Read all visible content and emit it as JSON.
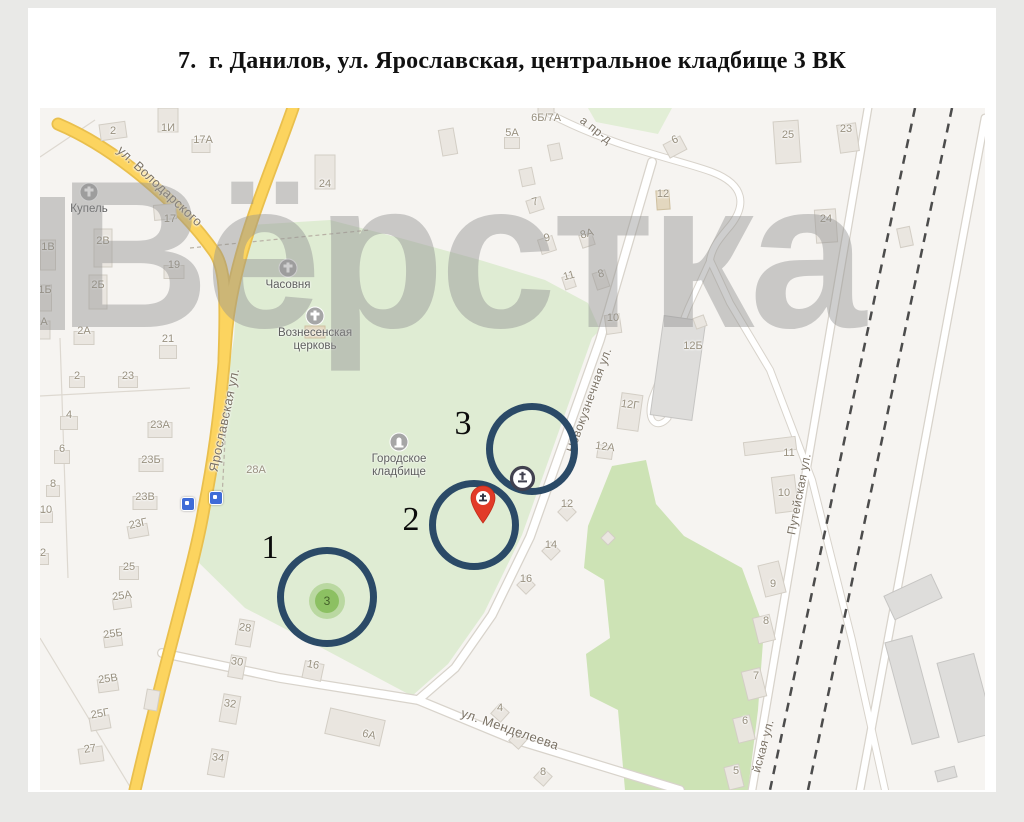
{
  "page": {
    "title": "7.  г. Данилов, ул. Ярославская, центральное кладбище 3 ВК"
  },
  "watermark": {
    "text": "Вёрстка"
  },
  "map": {
    "colors": {
      "circle_stroke": "#2b4a67",
      "pin_red": "#e23b28",
      "badge_ring": "#41414f",
      "green_point_fill": "#8cc062",
      "road_yellow": "#fcd45f",
      "cemetery_green": "#dfecd3"
    },
    "street_labels": [
      {
        "t": "ул. Володарского",
        "x": 120,
        "y": 78,
        "r": 43,
        "s": 13
      },
      {
        "t": "Ярославская ул.",
        "x": 184,
        "y": 312,
        "r": -78,
        "s": 13
      },
      {
        "t": "Новокузнечная ул.",
        "x": 549,
        "y": 292,
        "r": -70,
        "s": 12
      },
      {
        "t": "Путейская ул.",
        "x": 759,
        "y": 386,
        "r": -79,
        "s": 12
      },
      {
        "t": "йская ул.",
        "x": 723,
        "y": 638,
        "r": -75,
        "s": 12
      },
      {
        "t": "ул. Менделеева",
        "x": 470,
        "y": 621,
        "r": 19,
        "s": 13
      },
      {
        "t": "а пр-д",
        "x": 556,
        "y": 22,
        "r": 38,
        "s": 12
      }
    ],
    "building_labels": [
      {
        "t": "2",
        "x": 73,
        "y": 23
      },
      {
        "t": "1И",
        "x": 128,
        "y": 20
      },
      {
        "t": "17А",
        "x": 163,
        "y": 32
      },
      {
        "t": "24",
        "x": 285,
        "y": 76
      },
      {
        "t": "17",
        "x": 130,
        "y": 111
      },
      {
        "t": "2В",
        "x": 63,
        "y": 133
      },
      {
        "t": "1В",
        "x": 8,
        "y": 139
      },
      {
        "t": "19",
        "x": 134,
        "y": 157
      },
      {
        "t": "2Б",
        "x": 58,
        "y": 177
      },
      {
        "t": "1Б",
        "x": 5,
        "y": 182
      },
      {
        "t": "А",
        "x": 4,
        "y": 214
      },
      {
        "t": "2А",
        "x": 44,
        "y": 223
      },
      {
        "t": "21",
        "x": 128,
        "y": 231
      },
      {
        "t": "2",
        "x": 37,
        "y": 268
      },
      {
        "t": "23",
        "x": 88,
        "y": 268
      },
      {
        "t": "4",
        "x": 29,
        "y": 307
      },
      {
        "t": "23А",
        "x": 120,
        "y": 317
      },
      {
        "t": "6",
        "x": 22,
        "y": 341
      },
      {
        "t": "23Б",
        "x": 111,
        "y": 352
      },
      {
        "t": "8",
        "x": 13,
        "y": 376
      },
      {
        "t": "23В",
        "x": 105,
        "y": 389
      },
      {
        "t": "10",
        "x": 6,
        "y": 402
      },
      {
        "t": "23Г",
        "x": 98,
        "y": 416,
        "r": -12
      },
      {
        "t": "25",
        "x": 89,
        "y": 459
      },
      {
        "t": "2",
        "x": 3,
        "y": 445
      },
      {
        "t": "25А",
        "x": 82,
        "y": 488,
        "r": -8
      },
      {
        "t": "25Б",
        "x": 73,
        "y": 526,
        "r": -8
      },
      {
        "t": "25В",
        "x": 68,
        "y": 571,
        "r": -8
      },
      {
        "t": "25Г",
        "x": 60,
        "y": 606,
        "r": -10
      },
      {
        "t": "27",
        "x": 50,
        "y": 641,
        "r": -8
      },
      {
        "t": "28",
        "x": 205,
        "y": 520,
        "r": 8
      },
      {
        "t": "30",
        "x": 197,
        "y": 554,
        "r": 8
      },
      {
        "t": "32",
        "x": 190,
        "y": 596,
        "r": 8
      },
      {
        "t": "34",
        "x": 178,
        "y": 650,
        "r": 8
      },
      {
        "t": "16",
        "x": 273,
        "y": 557,
        "r": 10
      },
      {
        "t": "6А",
        "x": 329,
        "y": 627,
        "r": 13
      },
      {
        "t": "28А",
        "x": 216,
        "y": 362
      },
      {
        "t": "4",
        "x": 460,
        "y": 600
      },
      {
        "t": "6",
        "x": 478,
        "y": 627
      },
      {
        "t": "8",
        "x": 503,
        "y": 664
      },
      {
        "t": "5А",
        "x": 472,
        "y": 25
      },
      {
        "t": "6Б/7А",
        "x": 506,
        "y": 10
      },
      {
        "t": "7",
        "x": 495,
        "y": 94,
        "r": -15
      },
      {
        "t": "9",
        "x": 507,
        "y": 130,
        "r": -15
      },
      {
        "t": "8А",
        "x": 547,
        "y": 126,
        "r": -15
      },
      {
        "t": "6",
        "x": 635,
        "y": 32,
        "r": -25
      },
      {
        "t": "25",
        "x": 748,
        "y": 27
      },
      {
        "t": "23",
        "x": 806,
        "y": 21
      },
      {
        "t": "12",
        "x": 623,
        "y": 86
      },
      {
        "t": "24",
        "x": 786,
        "y": 111
      },
      {
        "t": "8",
        "x": 561,
        "y": 166,
        "r": -15
      },
      {
        "t": "11",
        "x": 529,
        "y": 168,
        "r": -15
      },
      {
        "t": "10",
        "x": 573,
        "y": 210
      },
      {
        "t": "12Б",
        "x": 653,
        "y": 238
      },
      {
        "t": "12Г",
        "x": 590,
        "y": 297,
        "r": 8
      },
      {
        "t": "12А",
        "x": 565,
        "y": 339,
        "r": 8
      },
      {
        "t": "12",
        "x": 527,
        "y": 396
      },
      {
        "t": "14",
        "x": 511,
        "y": 437
      },
      {
        "t": "16",
        "x": 486,
        "y": 471
      },
      {
        "t": "11",
        "x": 749,
        "y": 345
      },
      {
        "t": "10",
        "x": 744,
        "y": 385
      },
      {
        "t": "9",
        "x": 733,
        "y": 476
      },
      {
        "t": "8",
        "x": 726,
        "y": 513
      },
      {
        "t": "7",
        "x": 716,
        "y": 568
      },
      {
        "t": "6",
        "x": 705,
        "y": 613
      },
      {
        "t": "5",
        "x": 696,
        "y": 663
      }
    ],
    "building_footprints": [
      [
        73,
        23,
        26,
        16,
        -8,
        0
      ],
      [
        128,
        12,
        20,
        24,
        0,
        0
      ],
      [
        161,
        38,
        18,
        13,
        0,
        0
      ],
      [
        285,
        64,
        20,
        34,
        0,
        0
      ],
      [
        125,
        104,
        22,
        15,
        -5,
        0
      ],
      [
        63,
        140,
        18,
        38,
        0,
        0
      ],
      [
        8,
        147,
        15,
        30,
        0,
        0
      ],
      [
        134,
        164,
        20,
        13,
        0,
        0
      ],
      [
        58,
        184,
        18,
        34,
        0,
        0
      ],
      [
        5,
        190,
        13,
        26,
        0,
        0
      ],
      [
        44,
        230,
        20,
        13,
        0,
        0
      ],
      [
        128,
        244,
        17,
        13,
        0,
        0
      ],
      [
        4,
        222,
        12,
        18,
        0,
        0
      ],
      [
        37,
        274,
        15,
        11,
        0,
        0
      ],
      [
        88,
        274,
        19,
        11,
        0,
        0
      ],
      [
        29,
        315,
        17,
        13,
        0,
        0
      ],
      [
        120,
        322,
        24,
        15,
        0,
        0
      ],
      [
        22,
        349,
        15,
        13,
        0,
        0
      ],
      [
        111,
        357,
        24,
        13,
        0,
        0
      ],
      [
        13,
        383,
        13,
        11,
        0,
        0
      ],
      [
        105,
        395,
        24,
        13,
        0,
        0
      ],
      [
        6,
        409,
        13,
        11,
        0,
        0
      ],
      [
        98,
        423,
        20,
        12,
        -10,
        0
      ],
      [
        89,
        465,
        19,
        13,
        0,
        0
      ],
      [
        3,
        451,
        11,
        11,
        0,
        0
      ],
      [
        82,
        495,
        18,
        11,
        -8,
        0
      ],
      [
        73,
        533,
        18,
        11,
        -8,
        0
      ],
      [
        68,
        577,
        20,
        13,
        -8,
        0
      ],
      [
        60,
        615,
        20,
        13,
        -10,
        0
      ],
      [
        51,
        647,
        24,
        15,
        -8,
        0
      ],
      [
        112,
        592,
        13,
        20,
        10,
        0
      ],
      [
        205,
        525,
        15,
        26,
        10,
        0
      ],
      [
        197,
        559,
        15,
        22,
        10,
        0
      ],
      [
        190,
        601,
        17,
        28,
        10,
        0
      ],
      [
        178,
        655,
        17,
        26,
        10,
        0
      ],
      [
        273,
        563,
        19,
        17,
        12,
        0
      ],
      [
        315,
        619,
        56,
        26,
        13,
        0
      ],
      [
        460,
        605,
        13,
        13,
        42,
        0
      ],
      [
        478,
        632,
        13,
        13,
        42,
        0
      ],
      [
        503,
        669,
        13,
        13,
        42,
        0
      ],
      [
        472,
        35,
        15,
        11,
        0,
        0
      ],
      [
        506,
        2,
        16,
        10,
        0,
        0
      ],
      [
        495,
        97,
        15,
        13,
        -18,
        0
      ],
      [
        507,
        137,
        15,
        15,
        -18,
        0
      ],
      [
        547,
        132,
        13,
        13,
        -18,
        0
      ],
      [
        635,
        39,
        19,
        15,
        -28,
        0
      ],
      [
        747,
        34,
        25,
        42,
        -4,
        0
      ],
      [
        808,
        30,
        19,
        28,
        -8,
        0
      ],
      [
        623,
        92,
        13,
        19,
        -4,
        2
      ],
      [
        786,
        118,
        21,
        33,
        -4,
        0
      ],
      [
        561,
        172,
        13,
        17,
        -18,
        0
      ],
      [
        529,
        174,
        11,
        13,
        -18,
        0
      ],
      [
        573,
        216,
        15,
        19,
        -8,
        0
      ],
      [
        638,
        260,
        42,
        100,
        8,
        1
      ],
      [
        590,
        304,
        21,
        36,
        8,
        0
      ],
      [
        565,
        344,
        15,
        13,
        8,
        0
      ],
      [
        527,
        404,
        13,
        13,
        45,
        0
      ],
      [
        511,
        443,
        13,
        13,
        45,
        0
      ],
      [
        486,
        477,
        13,
        13,
        45,
        0
      ],
      [
        730,
        338,
        52,
        13,
        -7,
        0
      ],
      [
        745,
        386,
        23,
        36,
        -7,
        0
      ],
      [
        732,
        471,
        21,
        32,
        -14,
        0
      ],
      [
        724,
        521,
        17,
        26,
        -14,
        0
      ],
      [
        714,
        576,
        19,
        29,
        -14,
        0
      ],
      [
        704,
        621,
        17,
        25,
        -14,
        0
      ],
      [
        694,
        669,
        15,
        23,
        -14,
        0
      ],
      [
        873,
        489,
        52,
        26,
        -25,
        1
      ],
      [
        872,
        582,
        28,
        105,
        -15,
        1
      ],
      [
        926,
        590,
        38,
        82,
        -15,
        1
      ],
      [
        906,
        666,
        20,
        11,
        -15,
        1
      ],
      [
        408,
        34,
        15,
        26,
        -10,
        0
      ],
      [
        487,
        69,
        13,
        17,
        -12,
        0
      ],
      [
        660,
        214,
        11,
        11,
        -20,
        0
      ],
      [
        865,
        129,
        13,
        19,
        -12,
        0
      ],
      [
        275,
        224,
        20,
        12,
        0,
        2
      ],
      [
        515,
        44,
        12,
        16,
        -12,
        0
      ],
      [
        568,
        430,
        10,
        10,
        45,
        0
      ]
    ],
    "poi": [
      {
        "name": "kupel",
        "icon": "cross",
        "x": 49,
        "y": 84,
        "lines": [
          "Купель"
        ]
      },
      {
        "name": "chasovnya",
        "icon": "cross",
        "x": 248,
        "y": 160,
        "lines": [
          "Часовня"
        ]
      },
      {
        "name": "voznesenskaya-church",
        "icon": "cross",
        "x": 275,
        "y": 208,
        "lines": [
          "Вознесенская",
          "церковь"
        ]
      },
      {
        "name": "city-cemetery",
        "icon": "monument",
        "x": 359,
        "y": 334,
        "lines": [
          "Городское",
          "кладбище"
        ]
      }
    ],
    "bus_stops": [
      {
        "x": 148,
        "y": 396
      },
      {
        "x": 176,
        "y": 390
      }
    ],
    "highlight_circles": [
      {
        "label": "1",
        "cx": 287,
        "cy": 489,
        "r": 50,
        "lx": 230,
        "ly": 440
      },
      {
        "label": "2",
        "cx": 434,
        "cy": 417,
        "r": 45,
        "lx": 371,
        "ly": 412
      },
      {
        "label": "3",
        "cx": 492,
        "cy": 341,
        "r": 46,
        "lx": 423,
        "ly": 316
      }
    ],
    "point_markers": {
      "green_point": {
        "label": "3",
        "x": 287,
        "y": 493
      },
      "red_pin": {
        "x": 443,
        "y": 390
      },
      "monument_badge": {
        "x": 482,
        "y": 370
      }
    }
  }
}
